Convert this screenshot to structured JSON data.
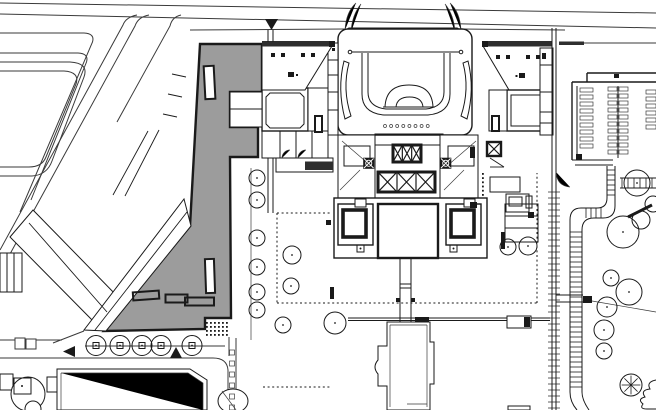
{
  "title": "Theater site plan with shaded new building",
  "colors": {
    "paper": "#ffffff",
    "ink": "#1a1a1a",
    "line": "#3a3a3a",
    "shade": "#9c9c9c",
    "hatch": "#2e2e2e"
  },
  "legend": {
    "shaded_polygon": "new building",
    "outlined_shapes": "existing buildings",
    "filled_triangles": "entrance markers",
    "circles": "trees"
  },
  "markers": {
    "north": "down-triangle",
    "west": "left-triangle",
    "south": "up-triangle"
  },
  "generated": {
    "tree_row": {
      "cy": 345.5,
      "r": 10,
      "sq": 6,
      "cx": [
        96,
        120,
        142,
        161,
        192
      ]
    },
    "tree_column": {
      "cx": 257,
      "r": 8,
      "cy": [
        178,
        200,
        238,
        267,
        292,
        310
      ]
    },
    "scatter_trees": [
      {
        "cx": 292,
        "cy": 255,
        "r": 9
      },
      {
        "cx": 291,
        "cy": 286,
        "r": 8
      },
      {
        "cx": 283,
        "cy": 325,
        "r": 8
      },
      {
        "cx": 335,
        "cy": 323,
        "r": 11
      },
      {
        "cx": 508,
        "cy": 247,
        "r": 8
      },
      {
        "cx": 528,
        "cy": 246,
        "r": 9
      }
    ],
    "right_trees": [
      {
        "cx": 637,
        "cy": 183,
        "r": 13
      },
      {
        "cx": 623,
        "cy": 232,
        "r": 16
      },
      {
        "cx": 641,
        "cy": 220,
        "r": 9,
        "nodot": 1
      },
      {
        "cx": 611,
        "cy": 278,
        "r": 8
      },
      {
        "cx": 629,
        "cy": 292,
        "r": 13
      },
      {
        "cx": 607,
        "cy": 307,
        "r": 10
      },
      {
        "cx": 604,
        "cy": 330,
        "r": 10
      },
      {
        "cx": 604,
        "cy": 351,
        "r": 8
      },
      {
        "cx": 653,
        "cy": 204,
        "r": 8,
        "nodot": 1
      }
    ],
    "asterisk_tree": {
      "cx": 631,
      "cy": 385,
      "r": 11
    },
    "ladders": [
      {
        "o": "v",
        "a1": 570,
        "a2": 582,
        "b0": 232,
        "b1": 390,
        "s": 5
      },
      {
        "o": "h",
        "a1": 208,
        "a2": 218,
        "b0": 586,
        "b1": 601,
        "s": 5
      },
      {
        "o": "v",
        "a1": 607,
        "a2": 615,
        "b0": 170,
        "b1": 196,
        "s": 5
      },
      {
        "o": "h",
        "a1": 178,
        "a2": 188,
        "b0": 622,
        "b1": 654,
        "s": 6
      }
    ],
    "fence_ticks": {
      "x1": 548,
      "x2": 560,
      "y0": 192,
      "y1": 408,
      "s": 6
    },
    "louver_columns": [
      {
        "x": 580,
        "w": 13,
        "y0": 88,
        "n": 9,
        "s": 7,
        "h": 4
      },
      {
        "x": 608,
        "w": 9,
        "y0": 87,
        "n": 10,
        "s": 7,
        "h": 4
      },
      {
        "x": 619,
        "w": 9,
        "y0": 87,
        "n": 10,
        "s": 7,
        "h": 4
      },
      {
        "x": 646,
        "w": 10,
        "y0": 90,
        "n": 6,
        "s": 7,
        "h": 4
      }
    ],
    "dot_grids": [
      {
        "x": 206,
        "y": 322,
        "nx": 3,
        "ny": 4,
        "s": 4
      },
      {
        "x": 218,
        "y": 322,
        "nx": 3,
        "ny": 4,
        "s": 4
      }
    ],
    "lane_dots": {
      "x": 229.5,
      "y0": 350,
      "n": 6,
      "s": 11,
      "w": 5
    },
    "stage_dots": {
      "y": 126,
      "x0": 385,
      "n": 8,
      "s": 6.1,
      "r": 1.5
    },
    "stair_dots": {
      "x": 482,
      "y0": 173,
      "n": 6,
      "s": 4.2
    },
    "xboxes": [
      {
        "x": 393,
        "y": 145,
        "w": 28,
        "h": 17,
        "n": 3,
        "t": 3
      },
      {
        "x": 378,
        "y": 172,
        "w": 57,
        "h": 20,
        "n": 3,
        "t": 3
      },
      {
        "x": 487,
        "y": 142,
        "w": 14,
        "h": 14,
        "n": 1,
        "t": 2.4
      },
      {
        "x": 364,
        "y": 158.5,
        "w": 9.5,
        "h": 9.5,
        "n": 1,
        "t": 1.6,
        "f": 1
      },
      {
        "x": 441,
        "y": 158.5,
        "w": 9.5,
        "h": 9.5,
        "n": 1,
        "t": 1.6,
        "f": 1
      }
    ],
    "black_squares": [
      [
        271,
        53,
        4,
        4
      ],
      [
        281,
        53,
        4,
        4
      ],
      [
        301,
        53,
        4,
        4
      ],
      [
        311,
        53,
        4,
        4
      ],
      [
        288,
        72,
        6,
        5
      ],
      [
        296,
        74,
        2,
        2
      ],
      [
        496,
        55,
        4,
        4
      ],
      [
        506,
        55,
        4,
        4
      ],
      [
        526,
        55,
        4,
        4
      ],
      [
        536,
        55,
        4,
        4
      ],
      [
        542,
        55,
        4,
        4
      ],
      [
        519,
        73,
        6,
        5
      ],
      [
        515.5,
        75,
        2,
        2
      ],
      [
        329,
        41,
        6,
        6
      ],
      [
        482,
        41,
        6,
        6
      ],
      [
        332,
        48,
        3,
        3
      ],
      [
        542,
        53,
        4,
        4
      ],
      [
        614,
        74,
        5,
        4
      ],
      [
        528,
        212,
        6,
        6
      ],
      [
        576,
        154,
        6,
        6
      ],
      [
        470,
        147,
        5,
        11
      ],
      [
        470,
        202,
        7,
        6
      ],
      [
        326,
        220,
        5,
        5
      ],
      [
        396,
        298,
        4,
        4
      ],
      [
        411,
        298,
        4,
        4
      ]
    ],
    "segments": [
      [
        172,
        74,
        186,
        77
      ],
      [
        168,
        94,
        182,
        97
      ],
      [
        163,
        114,
        177,
        117
      ],
      [
        148,
        131,
        113,
        195
      ],
      [
        159,
        130,
        125,
        196
      ],
      [
        490,
        158,
        504,
        167
      ],
      [
        490,
        167,
        504,
        167
      ],
      [
        29,
        223,
        107,
        312
      ],
      [
        187,
        212,
        95,
        330
      ]
    ]
  }
}
